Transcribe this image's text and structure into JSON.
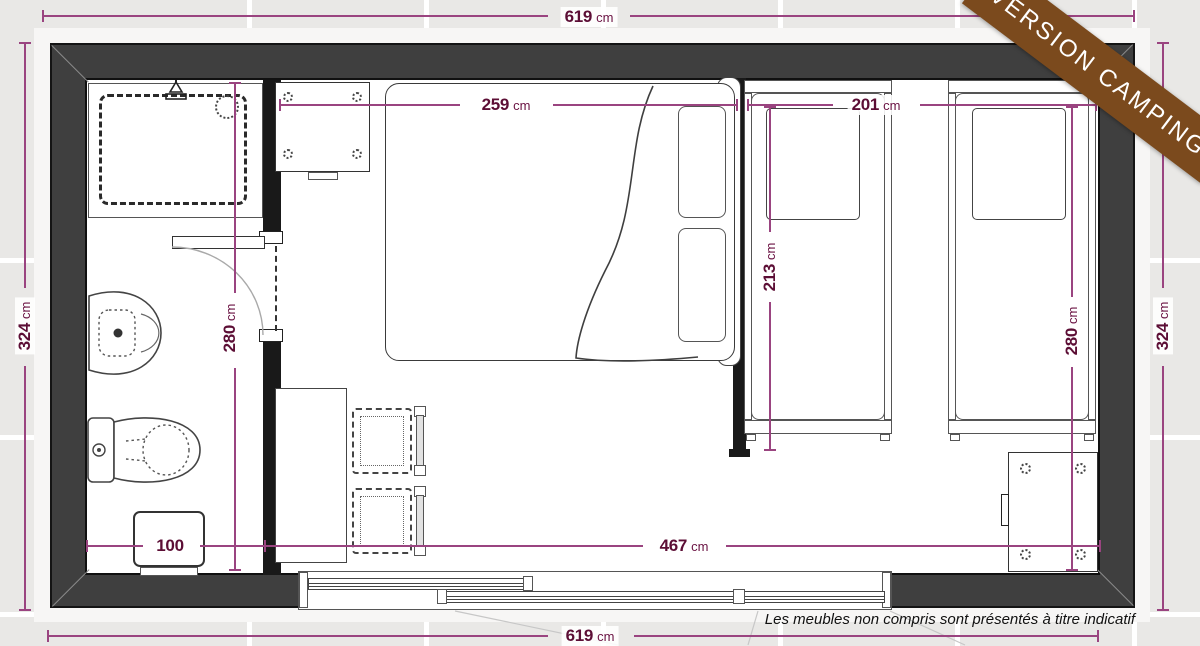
{
  "banner": {
    "label": "VERSION CAMPING"
  },
  "footnote": {
    "text": "Les meubles non compris sont présentés à titre indicatif"
  },
  "colors": {
    "dimension_line": "#9a4480",
    "dimension_text": "#5c0e35",
    "wall_fill": "#3f3f3f",
    "ribbon": "#7b4a1d",
    "background": "#e9e8e6"
  },
  "dimensions": {
    "top_width": {
      "value": "619",
      "unit": "cm"
    },
    "bottom_width": {
      "value": "619",
      "unit": "cm"
    },
    "left_height": {
      "value": "324",
      "unit": "cm"
    },
    "right_height": {
      "value": "324",
      "unit": "cm"
    },
    "double_bed_width": {
      "value": "259",
      "unit": "cm"
    },
    "twin_beds_span": {
      "value": "201",
      "unit": "cm"
    },
    "twin_bed_length": {
      "value": "213",
      "unit": "cm"
    },
    "bedroom_depth": {
      "value": "280",
      "unit": "cm"
    },
    "bathroom_depth": {
      "value": "280",
      "unit": "cm"
    },
    "bathroom_width": {
      "value": "100",
      "unit": ""
    },
    "living_width": {
      "value": "467",
      "unit": "cm"
    }
  }
}
